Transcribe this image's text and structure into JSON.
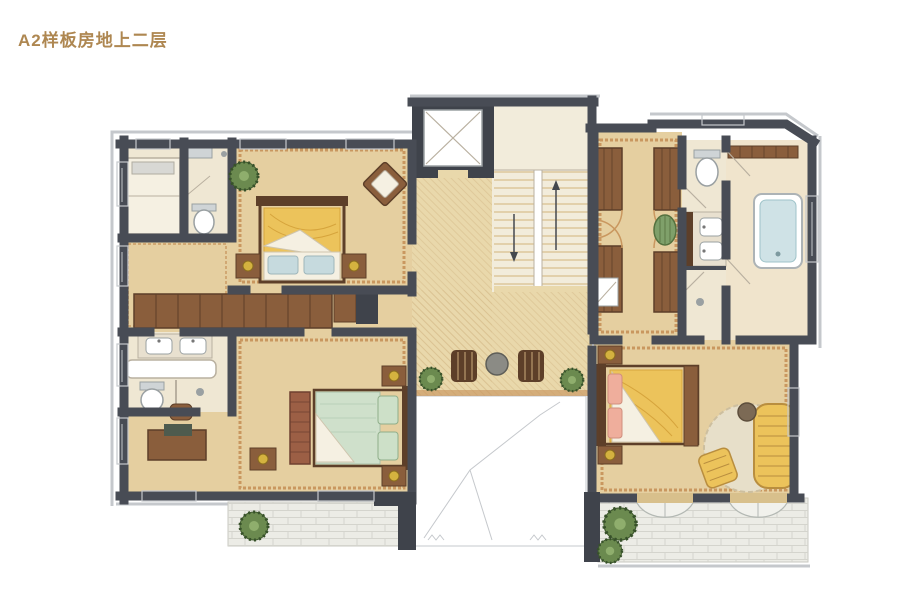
{
  "header": {
    "title": "A2样板房地上二层"
  },
  "palette": {
    "title_color": "#ae8751",
    "wall": "#484c55",
    "wall_light": "#c9ced4",
    "floor": "#e5cfa0",
    "floor_pale": "#efe7d3",
    "bath_floor": "#f0e4cc",
    "hall": "#e9d8ab",
    "hall_line": "#d8bf8e",
    "trim": "#c9975f",
    "wood": "#8a5e3c",
    "wood_dark": "#5d3f29",
    "charcoal": "#3f434b",
    "bed_yellow": "#ecc35b",
    "bed_green": "#cfe0cb",
    "pillow_blue": "#c6dade",
    "pillow_pink": "#efae9c",
    "sheet": "#f5f0e2",
    "water": "#cfe2e6",
    "stone": "#ecece6",
    "plant": "#6b8a4f",
    "plant_dark": "#41582f",
    "gold": "#d4b23f",
    "line_gray": "#b9b0a0",
    "frame_gray": "#c5c8cc",
    "rug": "#e7dfc9"
  },
  "plan": {
    "type": "residential-floor-plan",
    "style": "hand-rendered watercolor",
    "rooms": [
      "staff-bedroom",
      "staff-bathroom",
      "bedroom-1",
      "dressing-corridor",
      "bathroom-1",
      "bedroom-2",
      "study-nook",
      "central-hallway",
      "elevator",
      "staircase",
      "void-open-below",
      "sitting-area",
      "walk-in-closet",
      "wc",
      "vanity-room",
      "shower-room",
      "master-bathroom",
      "bedroom-3",
      "terrace-left",
      "terrace-right"
    ],
    "fixtures": [
      "canopy-bed",
      "double-bed",
      "single-bed",
      "nightstand-lamps",
      "wardrobe-row",
      "desk-with-chair",
      "double-sink-vanity",
      "bathtub",
      "toilets",
      "showers",
      "round-table-with-chairs",
      "chaise-lounge",
      "round-rug",
      "potted-plants",
      "stair-direction-arrows"
    ]
  }
}
